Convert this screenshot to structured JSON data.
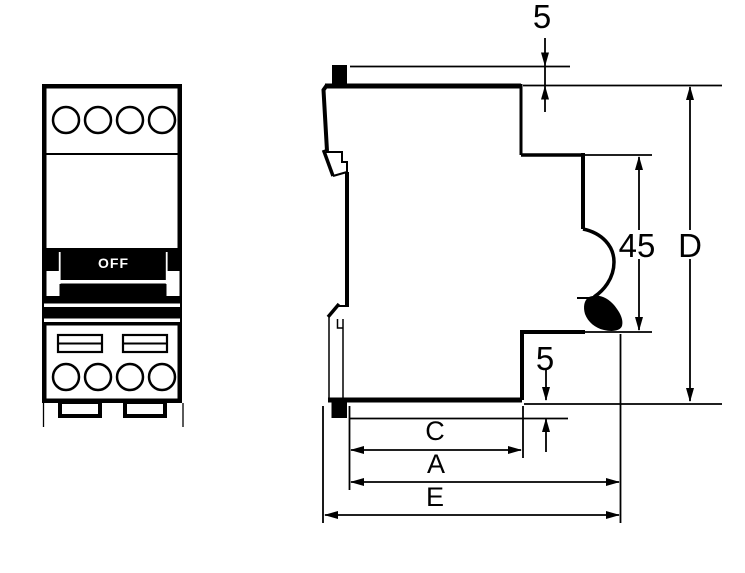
{
  "front_view": {
    "toggle_label": "OFF"
  },
  "dimensions": {
    "top_tab_protrusion": "5",
    "bottom_tab_protrusion": "5",
    "front_section_height": "45",
    "overall_depth": "D",
    "dim_c": "C",
    "dim_a": "A",
    "dim_e": "E"
  },
  "colors": {
    "line": "#000000",
    "background": "#ffffff",
    "toggle_fill": "#000000",
    "toggle_text": "#ffffff"
  }
}
